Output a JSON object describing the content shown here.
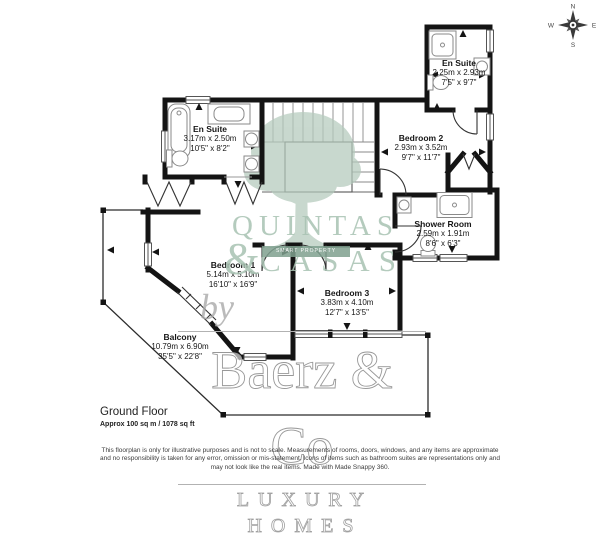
{
  "compass": {
    "n": "N",
    "e": "E",
    "s": "S",
    "w": "W"
  },
  "rooms": [
    {
      "name": "En Suite",
      "metric": "2.25m x 2.93m",
      "imperial": "7'5\" x 9'7\""
    },
    {
      "name": "En Suite",
      "metric": "3.17m x 2.50m",
      "imperial": "10'5\" x 8'2\""
    },
    {
      "name": "Bedroom 2",
      "metric": "2.93m x 3.52m",
      "imperial": "9'7\" x 11'7\""
    },
    {
      "name": "Shower Room",
      "metric": "2.59m x 1.91m",
      "imperial": "8'6\" x 6'3\""
    },
    {
      "name": "Bedroom 1",
      "metric": "5.14m x 5.10m",
      "imperial": "16'10\" x 16'9\""
    },
    {
      "name": "Bedroom 3",
      "metric": "3.83m x 4.10m",
      "imperial": "12'7\" x 13'5\""
    },
    {
      "name": "Balcony",
      "metric": "10.79m x 6.90m",
      "imperial": "35'5\" x 22'8\""
    }
  ],
  "watermarks": {
    "agency_top": "QUINTAS",
    "agency_amp": "&",
    "agency_bottom": "CASAS",
    "agency_banner": "SMART PROPERTY SERVICES",
    "by": "by",
    "brand": "Baerz & Co",
    "brand_sub": "LUXURY HOMES"
  },
  "footer": {
    "floor_label": "Ground Floor",
    "area": "Approx 100 sq m / 1078 sq ft",
    "disclaimer_line1": "This floorplan is only for illustrative purposes and is not to scale. Measurements of rooms, doors, windows, and any items are approximate",
    "disclaimer_line2": "and no responsibility is taken for any error, omission or mis-statement. Icons of items such as bathroom suites are representations only and",
    "disclaimer_line3": "may not look like the real items. Made with Made Snappy 360."
  },
  "colors": {
    "wall": "#141414",
    "fixture_gray": "#8a8a8a",
    "watermark_green": "#a8c2b2",
    "banner_green": "#7fa08f",
    "tree_green": "#b4cabc",
    "brand_gray": "#989898"
  }
}
